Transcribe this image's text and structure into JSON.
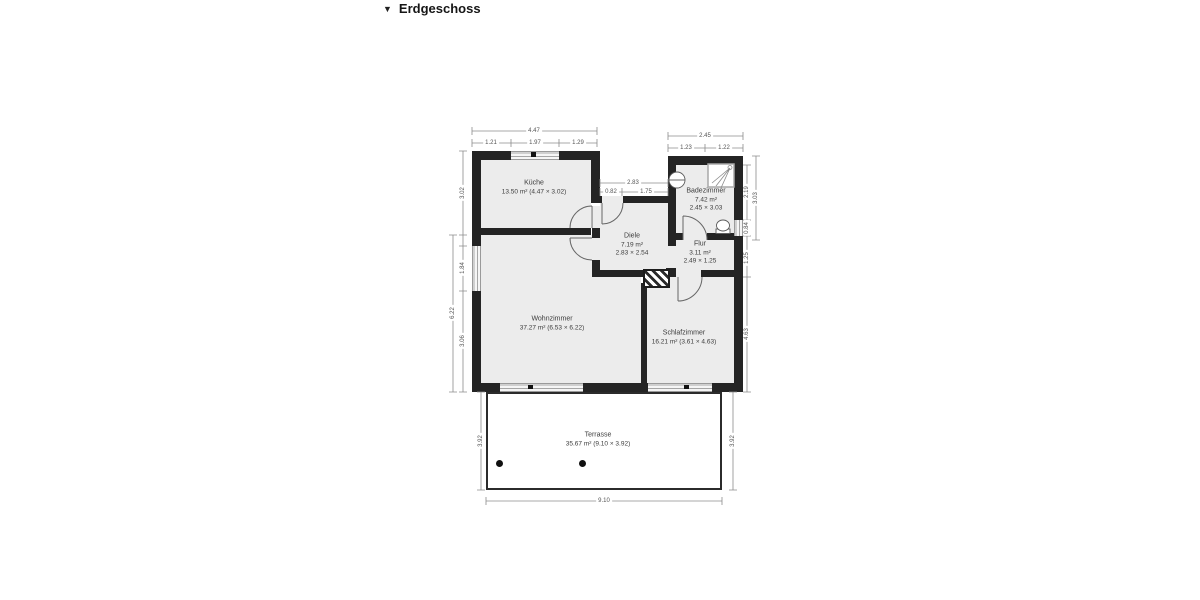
{
  "header": {
    "collapse_icon": "▼",
    "title": "Erdgeschoss"
  },
  "rooms": {
    "kueche": {
      "name": "Küche",
      "info": "13.50 m² (4.47 × 3.02)"
    },
    "badezimmer": {
      "name": "Badezimmer",
      "area": "7.42 m²",
      "size": "2.45 × 3.03"
    },
    "diele": {
      "name": "Diele",
      "area": "7.19 m²",
      "size": "2.83 × 2.54"
    },
    "flur": {
      "name": "Flur",
      "area": "3.11 m²",
      "size": "2.49 × 1.25"
    },
    "wohnzimmer": {
      "name": "Wohnzimmer",
      "info": "37.27 m² (6.53 × 6.22)"
    },
    "schlafzimmer": {
      "name": "Schlafzimmer",
      "info": "16.21 m² (3.61 × 4.63)"
    },
    "terrasse": {
      "name": "Terrasse",
      "info": "35.67 m² (9.10 × 3.92)"
    }
  },
  "dimension_labels": [
    {
      "text": "4.47",
      "x": 534,
      "y": 131,
      "rot": 0
    },
    {
      "text": "1.21",
      "x": 491,
      "y": 143,
      "rot": 0
    },
    {
      "text": "1.97",
      "x": 535,
      "y": 143,
      "rot": 0
    },
    {
      "text": "1.29",
      "x": 578,
      "y": 143,
      "rot": 0
    },
    {
      "text": "2.45",
      "x": 705,
      "y": 136,
      "rot": 0
    },
    {
      "text": "1.23",
      "x": 686,
      "y": 148,
      "rot": 0
    },
    {
      "text": "1.22",
      "x": 724,
      "y": 148,
      "rot": 0
    },
    {
      "text": "2.83",
      "x": 633,
      "y": 183,
      "rot": 0
    },
    {
      "text": "0.82",
      "x": 611,
      "y": 192,
      "rot": 0
    },
    {
      "text": "1.75",
      "x": 646,
      "y": 192,
      "rot": 0
    },
    {
      "text": "3.02",
      "x": 463,
      "y": 193,
      "rot": 90
    },
    {
      "text": "1.84",
      "x": 463,
      "y": 268,
      "rot": 90
    },
    {
      "text": "6.22",
      "x": 453,
      "y": 313,
      "rot": 90
    },
    {
      "text": "3.06",
      "x": 463,
      "y": 341,
      "rot": 90
    },
    {
      "text": "2.19",
      "x": 747,
      "y": 192,
      "rot": 90
    },
    {
      "text": "3.03",
      "x": 756,
      "y": 198,
      "rot": 90
    },
    {
      "text": "0.84",
      "x": 747,
      "y": 228,
      "rot": 90
    },
    {
      "text": "1.25",
      "x": 747,
      "y": 258,
      "rot": 90
    },
    {
      "text": "4.63",
      "x": 747,
      "y": 334,
      "rot": 90
    },
    {
      "text": "3.92",
      "x": 481,
      "y": 441,
      "rot": 90
    },
    {
      "text": "3.92",
      "x": 733,
      "y": 441,
      "rot": 90
    },
    {
      "text": "9.10",
      "x": 604,
      "y": 501,
      "rot": 0
    }
  ]
}
